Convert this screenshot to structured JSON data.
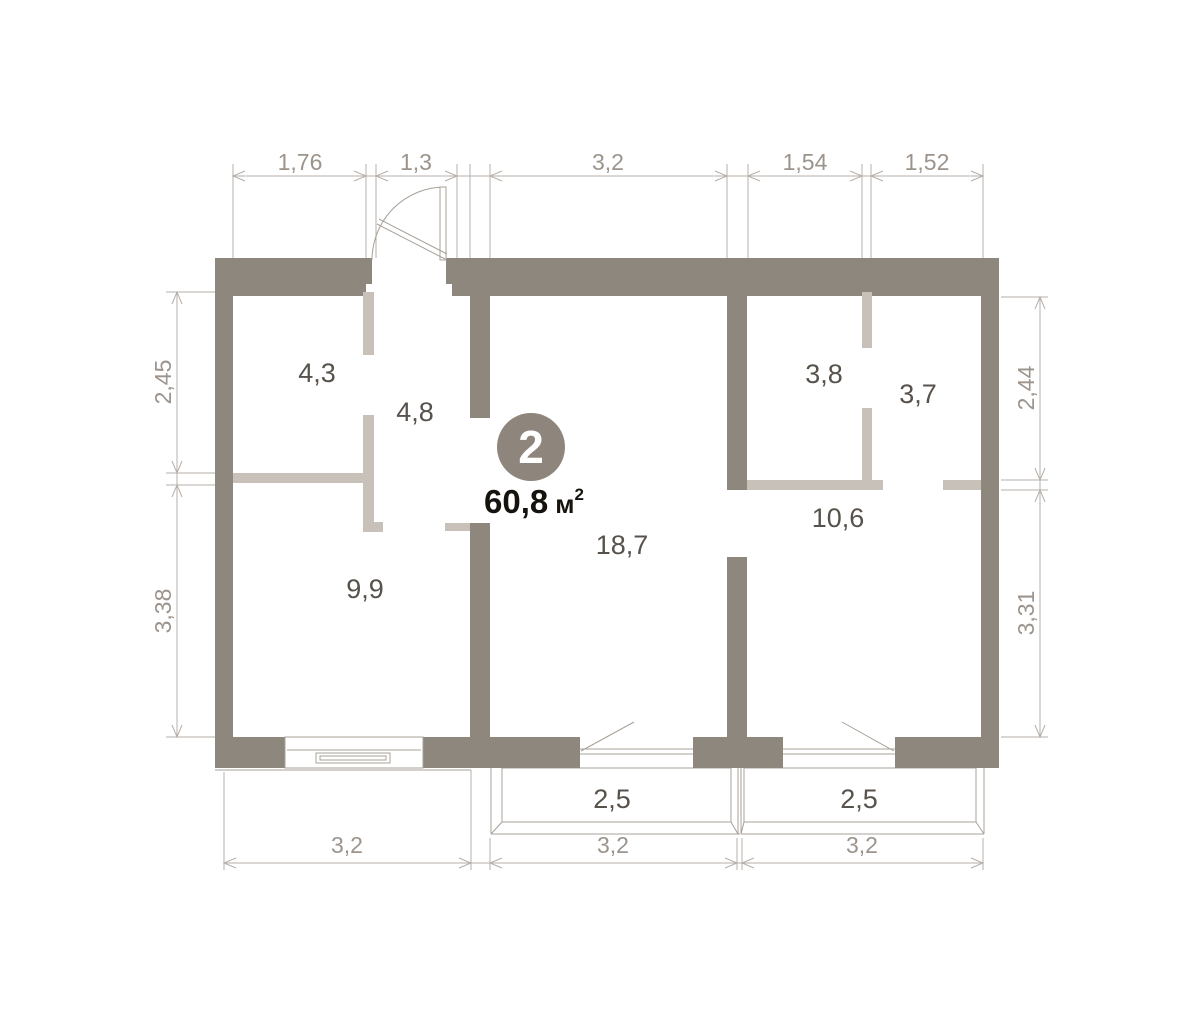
{
  "unit": {
    "number": "2",
    "area_value": "60,8",
    "area_unit": "м",
    "area_superscript": "2"
  },
  "room_areas": {
    "room_top_left": "4,3",
    "hallway": "4,8",
    "bedroom_left": "9,9",
    "living_room": "18,7",
    "storage_left": "3,8",
    "storage_right": "3,7",
    "bedroom_right": "10,6",
    "balcony_left": "2,5",
    "balcony_right": "2,5"
  },
  "dimensions": {
    "top": [
      "1,76",
      "1,3",
      "3,2",
      "1,54",
      "1,52"
    ],
    "left": [
      "2,45",
      "3,38"
    ],
    "right": [
      "2,44",
      "3,31"
    ],
    "bottom": [
      "3,2",
      "3,2",
      "3,2"
    ]
  },
  "colors": {
    "wall": "#8e877e",
    "partition": "#c8c1ba",
    "balcony_hatch": "#f0b3a9",
    "dim_text": "#9c948c",
    "dim_line": "#b6afa8",
    "area_text": "#57524c",
    "total_text": "#16120e",
    "badge_bg": "#8e857c",
    "badge_text": "#ffffff"
  }
}
